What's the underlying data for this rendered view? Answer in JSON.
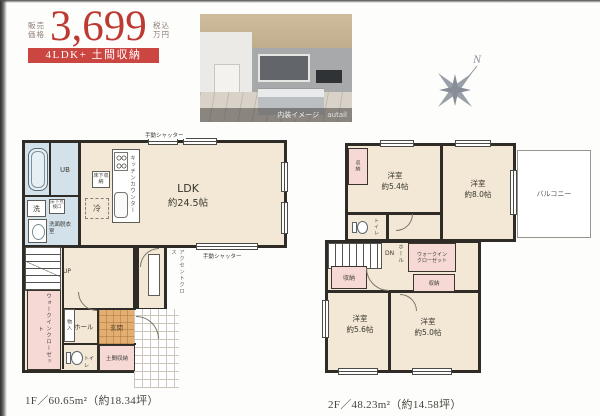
{
  "colors": {
    "price_red": "#bd3a33",
    "badge_bg": "#cb4541",
    "wall_dark": "#2f2b27",
    "floor_cream": "#f2e8d5",
    "wet_area_blue": "#d3e2ea",
    "storage_pink": "#f6d8d4",
    "entrance_tan": "#e3ae72"
  },
  "header": {
    "price_label": [
      "販売",
      "価格"
    ],
    "price_value": "3,699",
    "price_unit": [
      "税込",
      "万円"
    ],
    "badge": "4LDK+ 土間収納"
  },
  "photo": {
    "caption": "内装イメージ",
    "watermark": "autail"
  },
  "compass": {
    "north": "N"
  },
  "floor1": {
    "area_label": "1F／60.65m²（約18.34坪）",
    "labels": {
      "ldk": "LDK",
      "ldk_size": "約24.5帖",
      "kitchen_counter": "キッチンカウンター",
      "underfloor_storage": "床下収納",
      "inspection_hatch": "床下点検口",
      "fridge": "冷",
      "washer": "洗",
      "unit_bath": "UB",
      "washroom": "洗面脱衣室",
      "shutter_top": "手動シャッター",
      "shutter_bottom": "手動シャッター",
      "accent_cloth": "アクセントクロス",
      "stairs_up": "UP",
      "wic": "ウォークインクローゼット",
      "closet": "物入",
      "hall": "ホール",
      "entrance": "玄関",
      "toilet": "トイレ",
      "doma_storage": "土間収納"
    }
  },
  "floor2": {
    "area_label": "2F／48.23m²（約14.58坪）",
    "labels": {
      "stairs_down": "DN",
      "hall": "ホール",
      "wic": "ウォークインクローゼット",
      "storage_a": "収納",
      "storage_b": "収納",
      "storage_c": "収納",
      "toilet": "トイレ",
      "balcony": "バルコニー"
    },
    "rooms": {
      "a": {
        "name": "洋室",
        "size": "約5.4帖"
      },
      "b": {
        "name": "洋室",
        "size": "約8.0帖"
      },
      "c": {
        "name": "洋室",
        "size": "約5.6帖"
      },
      "d": {
        "name": "洋室",
        "size": "約5.0帖"
      }
    }
  }
}
